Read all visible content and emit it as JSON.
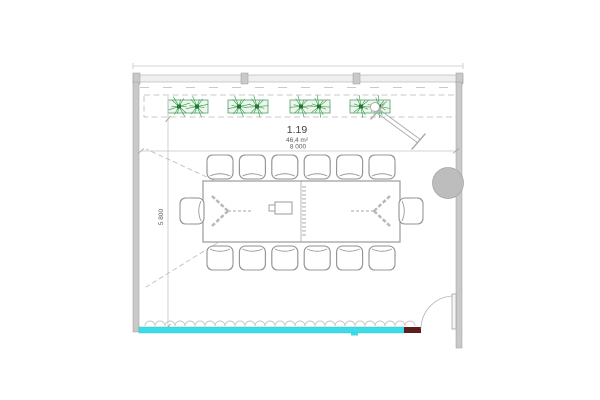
{
  "drawing": {
    "type": "architectural-floor-plan",
    "room": {
      "number": "1.19",
      "area_label": "46,4 m²"
    },
    "dimensions": {
      "horizontal": "8 000",
      "vertical": "5 800"
    },
    "colors": {
      "glass_facade": "#3EDCE6",
      "facade_panel": "#5A1E1E",
      "plant_stroke": "#2E9C45",
      "plant_center": "#1E7A33",
      "planter_stroke": "#55A06A",
      "planter_fill": "#EDF5ED",
      "wall_fill": "#C9C9C9",
      "line": "#9A9A9A",
      "column_fill": "#BDBDBD"
    },
    "furniture": {
      "chairs_top_row": 6,
      "chairs_bottom_row": 6,
      "chairs_table_ends": 2,
      "planter_boxes": 4,
      "plants_per_box": 2,
      "tables": 1,
      "projectors": 1,
      "flipcharts": 1,
      "columns": 1,
      "doors": 1
    }
  }
}
